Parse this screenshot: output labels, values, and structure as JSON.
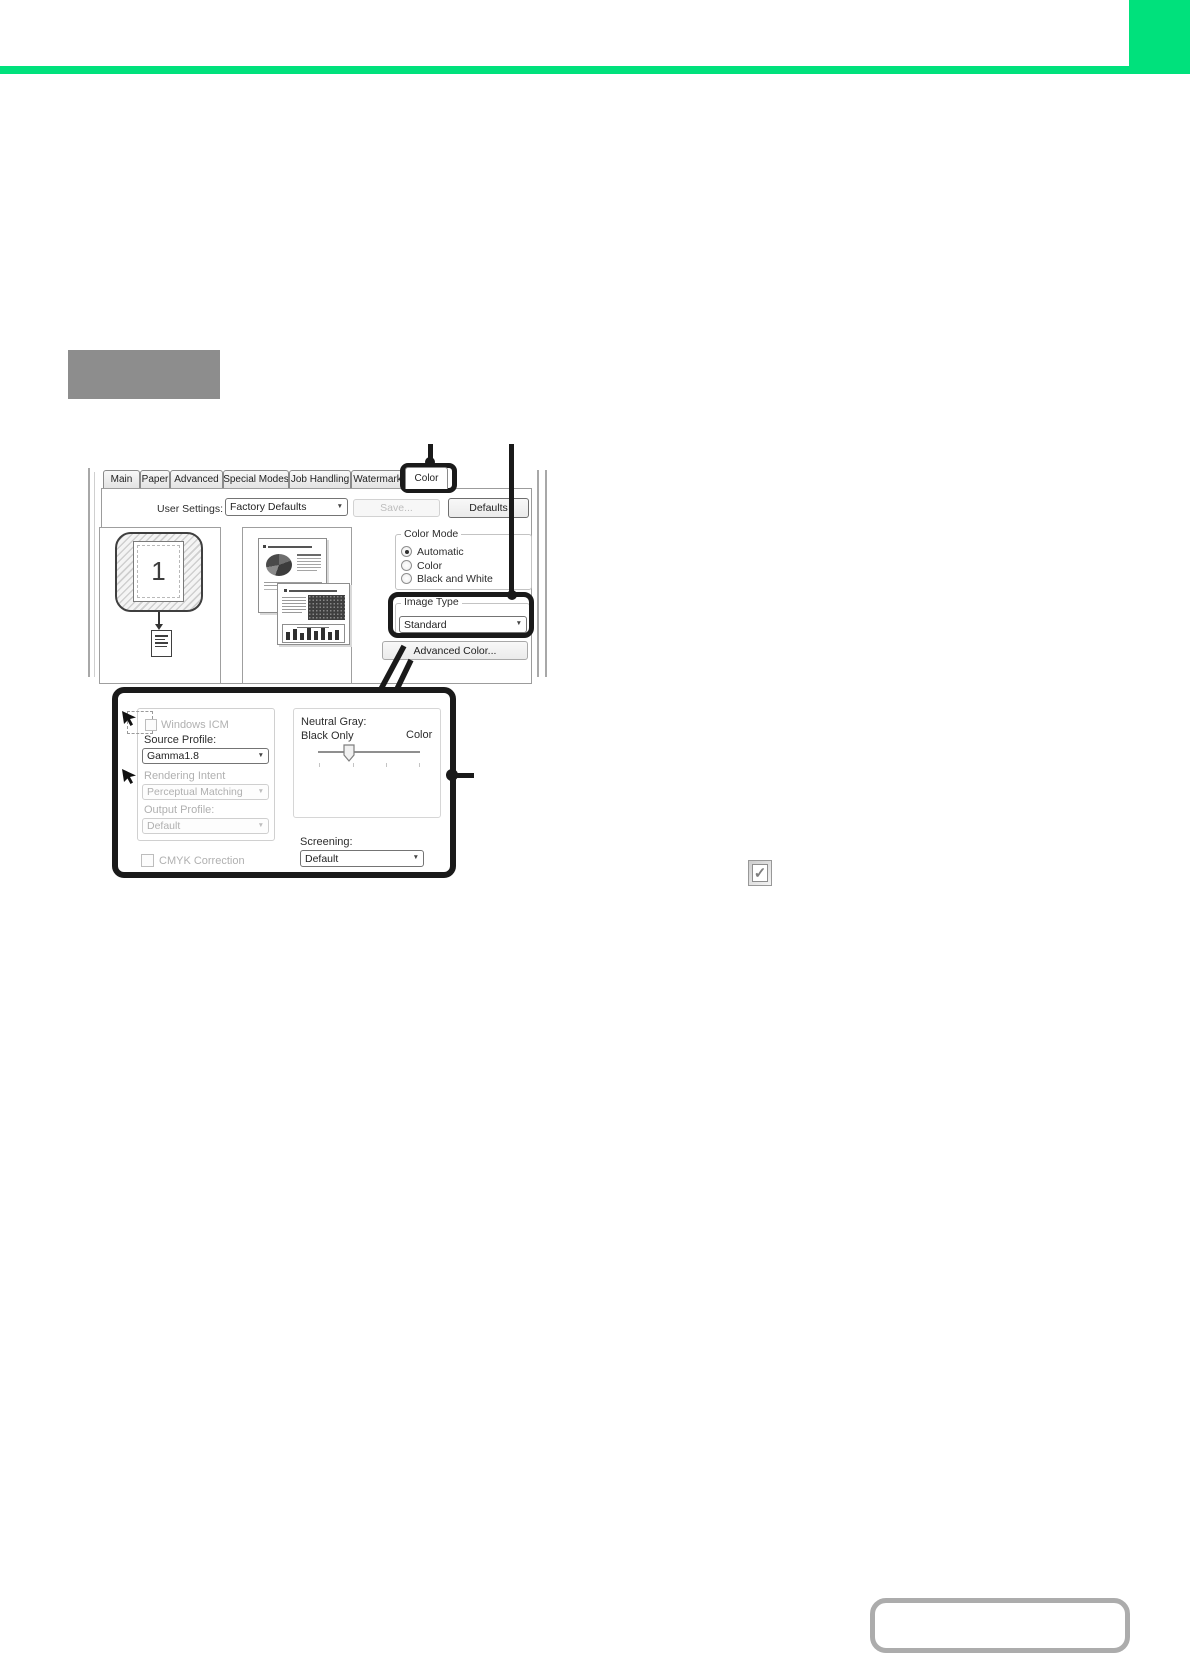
{
  "colors": {
    "accent_green": "#00E17C",
    "heading_gray": "#8D8D8D",
    "callout_black": "#1A1A1A",
    "bottom_box_border": "#ACACAC"
  },
  "icons": {
    "dropdown_arrow": "▼",
    "check_mark": "✓"
  },
  "dialog": {
    "tabs": [
      {
        "label": "Main"
      },
      {
        "label": "Paper"
      },
      {
        "label": "Advanced"
      },
      {
        "label": "Special Modes"
      },
      {
        "label": "Job Handling"
      },
      {
        "label": "Watermark"
      },
      {
        "label": "Color",
        "selected": true
      }
    ],
    "user_settings": {
      "label": "User Settings:",
      "value": "Factory Defaults",
      "save_button": "Save...",
      "defaults_button": "Defaults"
    },
    "preview": {
      "page_number": "1"
    },
    "color_mode": {
      "title": "Color Mode",
      "options": [
        {
          "label": "Automatic",
          "selected": true
        },
        {
          "label": "Color",
          "selected": false
        },
        {
          "label": "Black and White",
          "selected": false
        }
      ]
    },
    "image_type": {
      "title": "Image Type",
      "value": "Standard"
    },
    "advanced_color_button": "Advanced Color..."
  },
  "detail_panel": {
    "windows_icm": {
      "label": "Windows ICM",
      "checked": false
    },
    "source_profile": {
      "label": "Source Profile:",
      "value": "Gamma1.8"
    },
    "rendering_intent": {
      "label": "Rendering Intent",
      "value": "Perceptual Matching"
    },
    "output_profile": {
      "label": "Output Profile:",
      "value": "Default"
    },
    "cmyk_correction": {
      "label": "CMYK Correction",
      "checked": false
    },
    "neutral_gray": {
      "title": "Neutral Gray:",
      "left_label": "Black Only",
      "right_label": "Color",
      "slider_position": 0.3
    },
    "screening": {
      "label": "Screening:",
      "value": "Default"
    }
  }
}
